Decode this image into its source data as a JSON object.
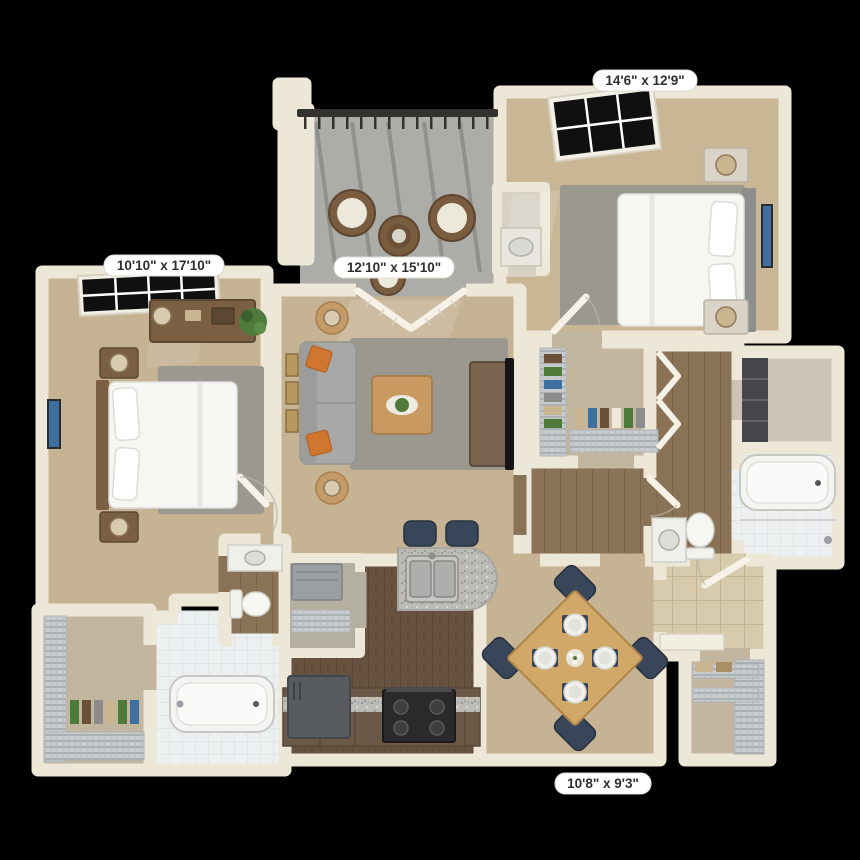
{
  "scene": {
    "description": "3D top-down rendering of a two-bedroom apartment floor plan on a black background",
    "background_color": "#000000",
    "wall_color": "#EDE7D8",
    "carpet_color": "#C6B394",
    "kitchen_wood_color": "#66523F",
    "hall_wood_color": "#8A7256",
    "rug_color": "#9B988F",
    "accent_pillow_color": "#D0762F",
    "dining_chair_color": "#39465A",
    "granite_color": "#BDBBB6",
    "balcony_floor_color": "#ACACA8",
    "label_background": "#FFFFFF",
    "label_text_color": "#2E2E33"
  },
  "labels": {
    "bedroom_right": {
      "text": "14'6\" x 12'9\""
    },
    "bedroom_left": {
      "text": "10'10\" x 17'10\""
    },
    "living_room": {
      "text": "12'10\" x 15'10\""
    },
    "dining_area": {
      "text": "10'8\" x 9'3\""
    }
  },
  "rooms": [
    {
      "id": "bedroom-right",
      "dimensions": "14'6\" x 12'9\"",
      "furnishings": [
        "queen bed with white bedding",
        "gray headboard",
        "two nightstands with lamps",
        "wall art",
        "black grid window",
        "gray area rug",
        "vanity nook with sink"
      ]
    },
    {
      "id": "balcony",
      "furnishings": [
        "dark metal railing",
        "two wicker chairs with white cushions",
        "round wicker table",
        "third chair"
      ]
    },
    {
      "id": "living-room",
      "dimensions": "12'10\" x 15'10\"",
      "furnishings": [
        "gray sofa with orange accent pillows",
        "two round end tables with lamps",
        "wood coffee table with plant",
        "gray area rug",
        "french doors to balcony",
        "tv console with tv",
        "wall frames"
      ]
    },
    {
      "id": "bedroom-left",
      "dimensions": "10'10\" x 17'10\"",
      "furnishings": [
        "queen bed with white bedding",
        "wood headboard",
        "two nightstands with lamps",
        "dresser with lamp",
        "potted plant",
        "blue wall art",
        "black grid window",
        "gray area rug"
      ]
    },
    {
      "id": "walk-in-closet-right",
      "furnishings": [
        "wire shelving",
        "hanging clothes"
      ]
    },
    {
      "id": "bathroom-right",
      "furnishings": [
        "bathtub with shower",
        "toilet",
        "vanity sink",
        "bi-fold closet doors",
        "linen closet with dark shelving"
      ]
    },
    {
      "id": "kitchen",
      "furnishings": [
        "granite peninsula with double sink",
        "two navy bar stools",
        "black range with burners",
        "refrigerator",
        "brown cabinets with granite counter",
        "utility closet with water heater and wire shelf"
      ]
    },
    {
      "id": "dining-area",
      "dimensions": "10'8\" x 9'3\"",
      "furnishings": [
        "square wood table rotated 45 degrees",
        "four navy chairs",
        "four place settings with plates",
        "floral centerpiece"
      ]
    },
    {
      "id": "entry",
      "furnishings": [
        "beige tile floor",
        "open front door",
        "console table",
        "coat closet with wire shelving"
      ]
    },
    {
      "id": "bathroom-left",
      "furnishings": [
        "bathtub",
        "toilet",
        "vanity sink",
        "walk-in closet with wire shelving and hanging clothes"
      ]
    }
  ]
}
